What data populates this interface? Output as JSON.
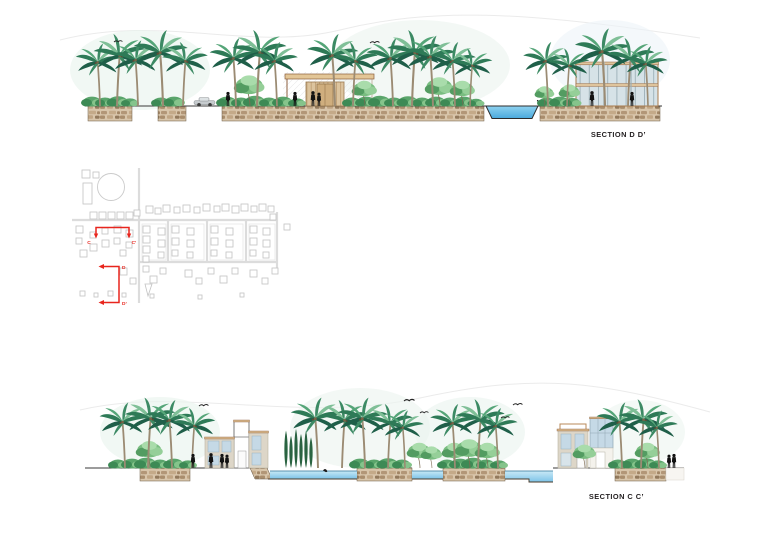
{
  "sheet": {
    "title_top": "SECTION D D’",
    "title_bottom": "SECTION C C’"
  },
  "site_plan": {
    "markers": {
      "c": "C",
      "c_prime": "C’",
      "d": "D",
      "d_prime": "D’"
    }
  },
  "colors": {
    "accent_red": "#e8251d",
    "water": "#5fb9e6",
    "water_light": "#c9e9f6",
    "stone": "#d8c5aa",
    "stone_dark": "#a98d6d",
    "frame_tan": "#d9b98c",
    "frame_brown": "#8b5e3c",
    "glass": "#d6e2e7",
    "wall_beige": "#ddd6c8",
    "foliage_dark": "#1f5f49",
    "foliage_mid": "#3c8a64",
    "foliage_light": "#7fbf97",
    "ground_line": "#3a3a3a",
    "plan_gray": "#c2c2c2",
    "label_color": "#231f20"
  }
}
